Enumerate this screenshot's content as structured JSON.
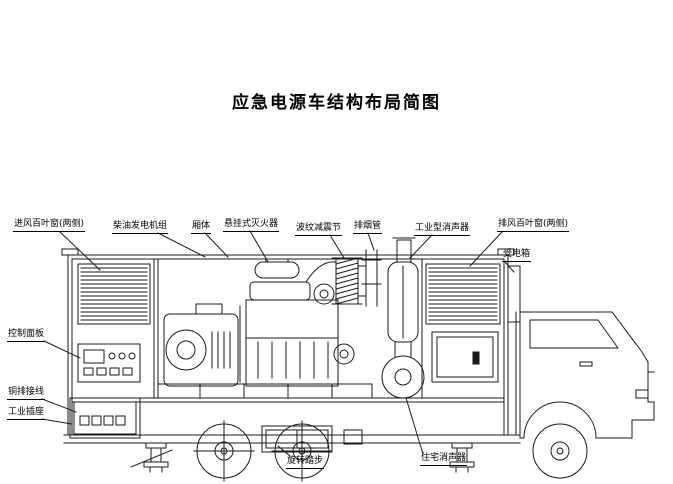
{
  "page": {
    "title": "应急电源车结构布局简图"
  },
  "labels": {
    "intake_louver": "进风百叶窗(两侧)",
    "genset": "柴油发电机组",
    "box_body": "厢体",
    "extinguisher": "悬挂式灭火器",
    "bellows": "波纹减震节",
    "exhaust_pipe": "排烟管",
    "industrial_muffler": "工业型消声器",
    "exhaust_louver": "排风百叶窗(两侧)",
    "power_box": "受电箱",
    "control_panel": "控制面板",
    "busbar_terminal": "铜排接线",
    "industrial_socket": "工业插座",
    "rotating_step": "旋转踏步",
    "residential_muffler": "住宅消声器"
  },
  "colors": {
    "line": "#1a1a1a",
    "background": "#ffffff"
  }
}
